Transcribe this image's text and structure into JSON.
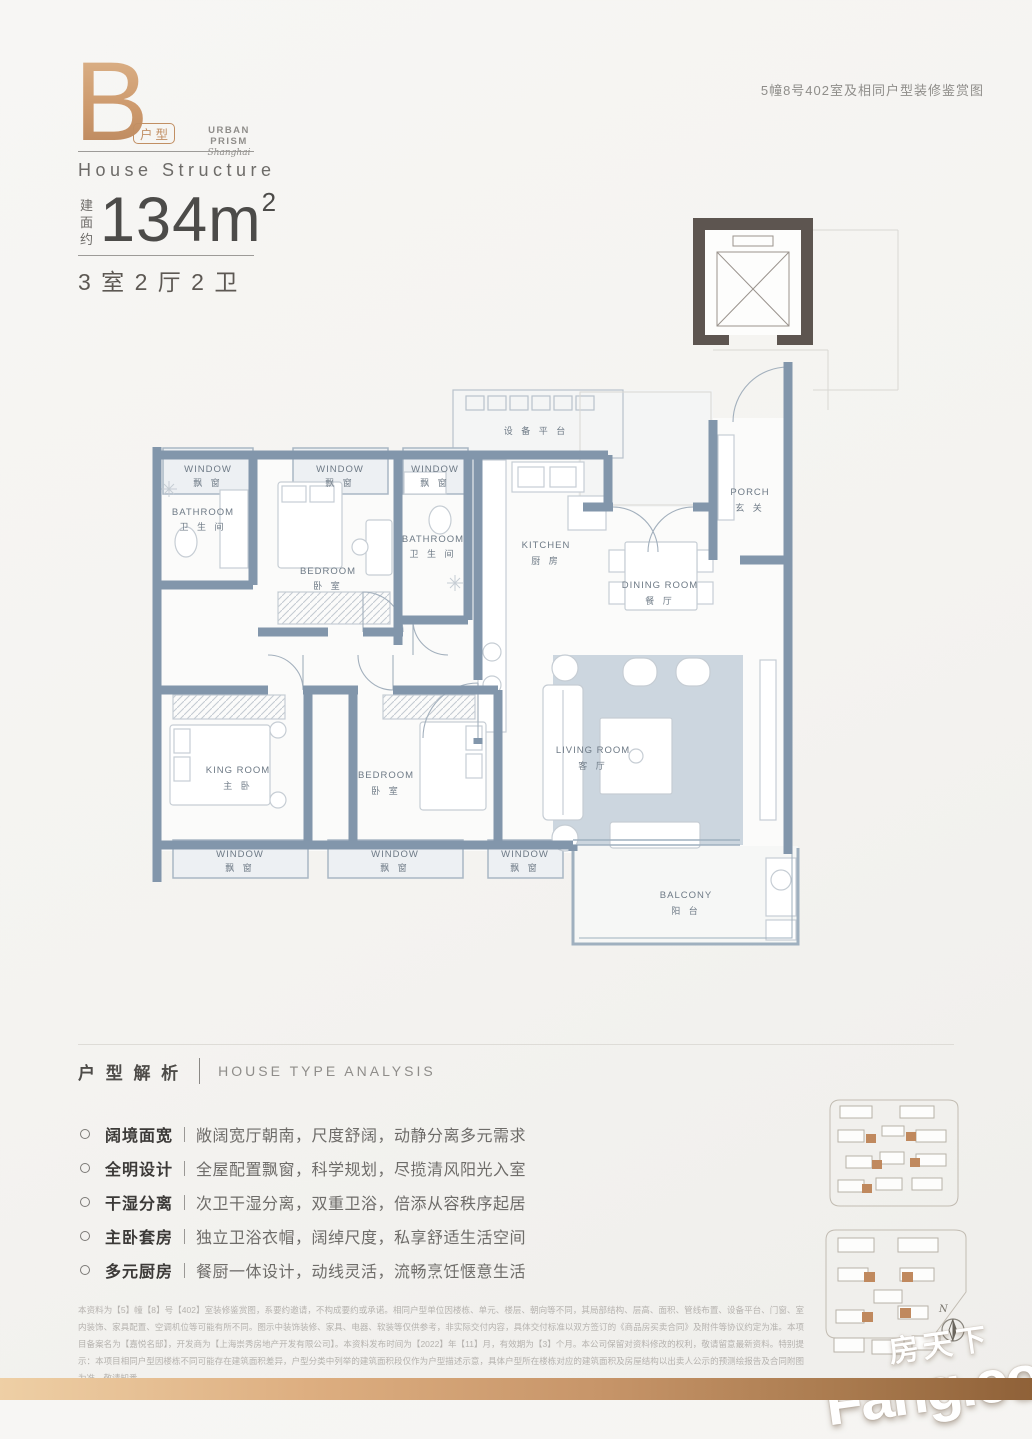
{
  "header": {
    "type_letter": "B",
    "type_tag": "户型",
    "brand_name": "URBAN PRISM",
    "brand_sub": "Shanghai",
    "structure_title": "House Structure",
    "area_prefix": "建面约",
    "area_value": "134m",
    "area_sup": "2",
    "layout_summary": "3 室 2 厅 2 卫"
  },
  "top_note": "5幢8号402室及相同户型装修鉴赏图",
  "floorplan": {
    "labels": {
      "equipment": "设 备 平 台",
      "window_en": "WINDOW",
      "window_cn": "飘 窗",
      "bathroom_en": "BATHROOM",
      "bathroom_cn": "卫 生 间",
      "bedroom_en": "BEDROOM",
      "bedroom_cn": "卧 室",
      "kitchen_en": "KITCHEN",
      "kitchen_cn": "厨 房",
      "dining_en": "DINING ROOM",
      "dining_cn": "餐 厅",
      "porch_en": "PORCH",
      "porch_cn": "玄 关",
      "king_en": "KING ROOM",
      "king_cn": "主 卧",
      "living_en": "LIVING ROOM",
      "living_cn": "客 厅",
      "balcony_en": "BALCONY",
      "balcony_cn": "阳 台"
    }
  },
  "analysis": {
    "title_cn": "户 型 解 析",
    "title_en": "HOUSE TYPE ANALYSIS",
    "items": [
      {
        "label": "阔境面宽",
        "desc": "敞阔宽厅朝南，尺度舒阔，动静分离多元需求"
      },
      {
        "label": "全明设计",
        "desc": "全屋配置飘窗，科学规划，尽揽清风阳光入室"
      },
      {
        "label": "干湿分离",
        "desc": "次卫干湿分离，双重卫浴，倍添从容秩序起居"
      },
      {
        "label": "主卧套房",
        "desc": "独立卫浴衣帽，阔绰尺度，私享舒适生活空间"
      },
      {
        "label": "多元厨房",
        "desc": "餐厨一体设计，动线灵活，流畅烹饪惬意生活"
      }
    ]
  },
  "compass_n": "N",
  "disclaimer": "本资料为【5】幢【8】号【402】室装修鉴赏图，系要约邀请，不构成要约或承诺。相同户型单位因楼栋、单元、楼层、朝向等不同，其局部结构、层高、面积、管线布置、设备平台、门窗、室内装饰、家具配置、空调机位等可能有所不同。图示中装饰装修、家具、电器、软装等仅供参考，非实际交付内容，具体交付标准以双方签订的《商品房买卖合同》及附件等协议约定为准。本项目备案名为【嘉悦名邸】，开发商为【上海崇秀房地产开发有限公司】。本资料发布时间为【2022】年【11】月，有效期为【3】个月。本公司保留对资料修改的权利，敬请留意最新资料。特别提示：本项目相同户型因楼栋不同可能存在建筑面积差异，户型分类中列举的建筑面积段仅作为户型描述示意，具体户型所在楼栋对应的建筑面积及房屋结构以出卖人公示的预测绘报告及合同附图为准。敬请知悉。",
  "watermark": {
    "cn": "房天下",
    "en": "Fang.com"
  },
  "colors": {
    "accent_copper": "#c18f63",
    "wall_slate": "#8296ab",
    "elevator_wall": "#5d5550",
    "rug": "#ccd6df",
    "bar_gradient_start": "#eecfa5",
    "bar_gradient_end": "#8f6138"
  }
}
